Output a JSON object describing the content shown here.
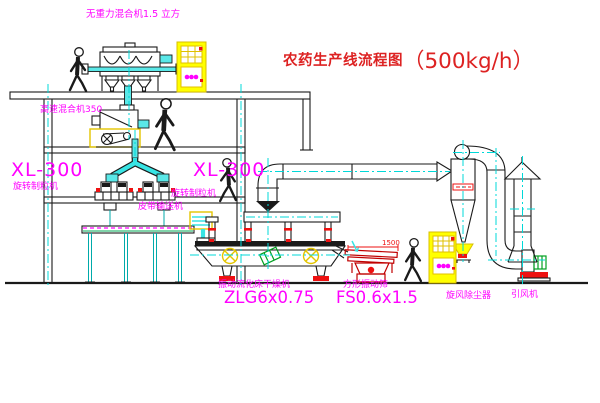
{
  "title": {
    "text": "农药生产线流程图",
    "capacity": "（500kg/h）",
    "color": "#dd2222"
  },
  "labels": {
    "gravity_mixer": "无重力混合机1.5 立方",
    "high_speed_mixer": "高速混合机350",
    "granulator_left_model": "XL-300",
    "granulator_left_name": "旋转制粒机",
    "granulator_mid_model": "XL-300",
    "granulator_mid_name": "旋转制粒机",
    "belt_conveyor": "皮带输送机",
    "dryer_name": "振动流化床干燥机",
    "dryer_model": "ZLG6x0.75",
    "screen_name": "方形振动筛",
    "screen_model": "FS0.6x1.5",
    "cyclone_name": "旋风除尘器",
    "fan_name": "引风机",
    "screen_dimension": "1500"
  },
  "colors": {
    "background": "#ffffff",
    "line_black": "#1a1a1a",
    "centerline_cyan": "#00d8d8",
    "label_magenta": "#ff00ff",
    "title_red": "#dd2222",
    "highlight_yellow": "#ffff00",
    "accent_red": "#ee1111",
    "accent_green": "#00a020",
    "screen_dark_red": "#c00000"
  }
}
